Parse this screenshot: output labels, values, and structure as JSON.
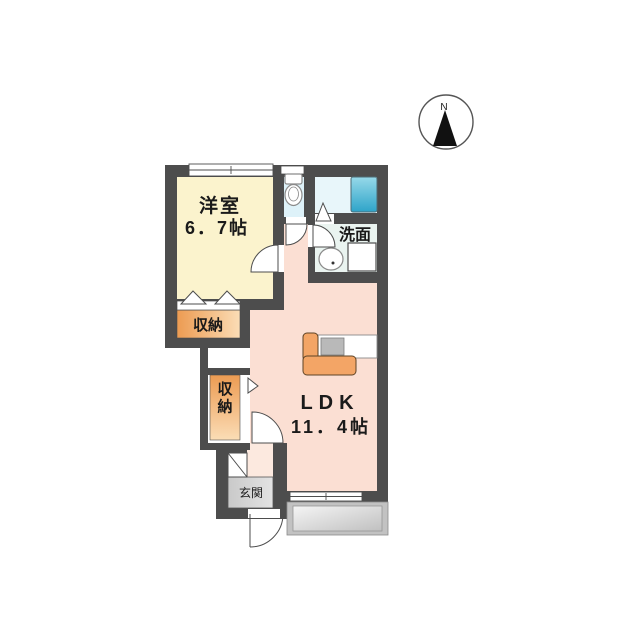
{
  "plan": {
    "title_hint": "apartment floor plan",
    "rooms": {
      "western_room": {
        "label": "洋室",
        "size": "6．7帖"
      },
      "ldk": {
        "label": "LDK",
        "size": "11．4帖"
      },
      "washroom": {
        "label": "洗面"
      },
      "storage_upper": {
        "label": "収納"
      },
      "storage_lower": {
        "label": "収納"
      },
      "entrance": {
        "label": "玄関"
      }
    },
    "fixtures": [
      "toilet",
      "bathtub",
      "sink",
      "washing-machine-pan",
      "kitchen-counter",
      "stove",
      "shoe-cabinet",
      "balcony"
    ],
    "colors": {
      "wall": "#4d4d4d",
      "western_room_floor": "#fbf3cd",
      "ldk_floor": "#fbdfd3",
      "entrance_hall_floor": "#fce9df",
      "toilet_floor": "#def2f9",
      "bath_floor": "#e8f6fa",
      "washroom_floor": "#eaf4f0",
      "storage_orange_dark": "#ec9b52",
      "storage_orange_light": "#fbddb6",
      "bathtub_light": "#96d9e9",
      "bathtub_dark": "#2ea4c9",
      "entrance_floor": "#d6d6d6",
      "balcony_frame": "#c2c2c2",
      "kitchen_orange": "#f3a566"
    }
  },
  "compass": {
    "label": "N"
  }
}
